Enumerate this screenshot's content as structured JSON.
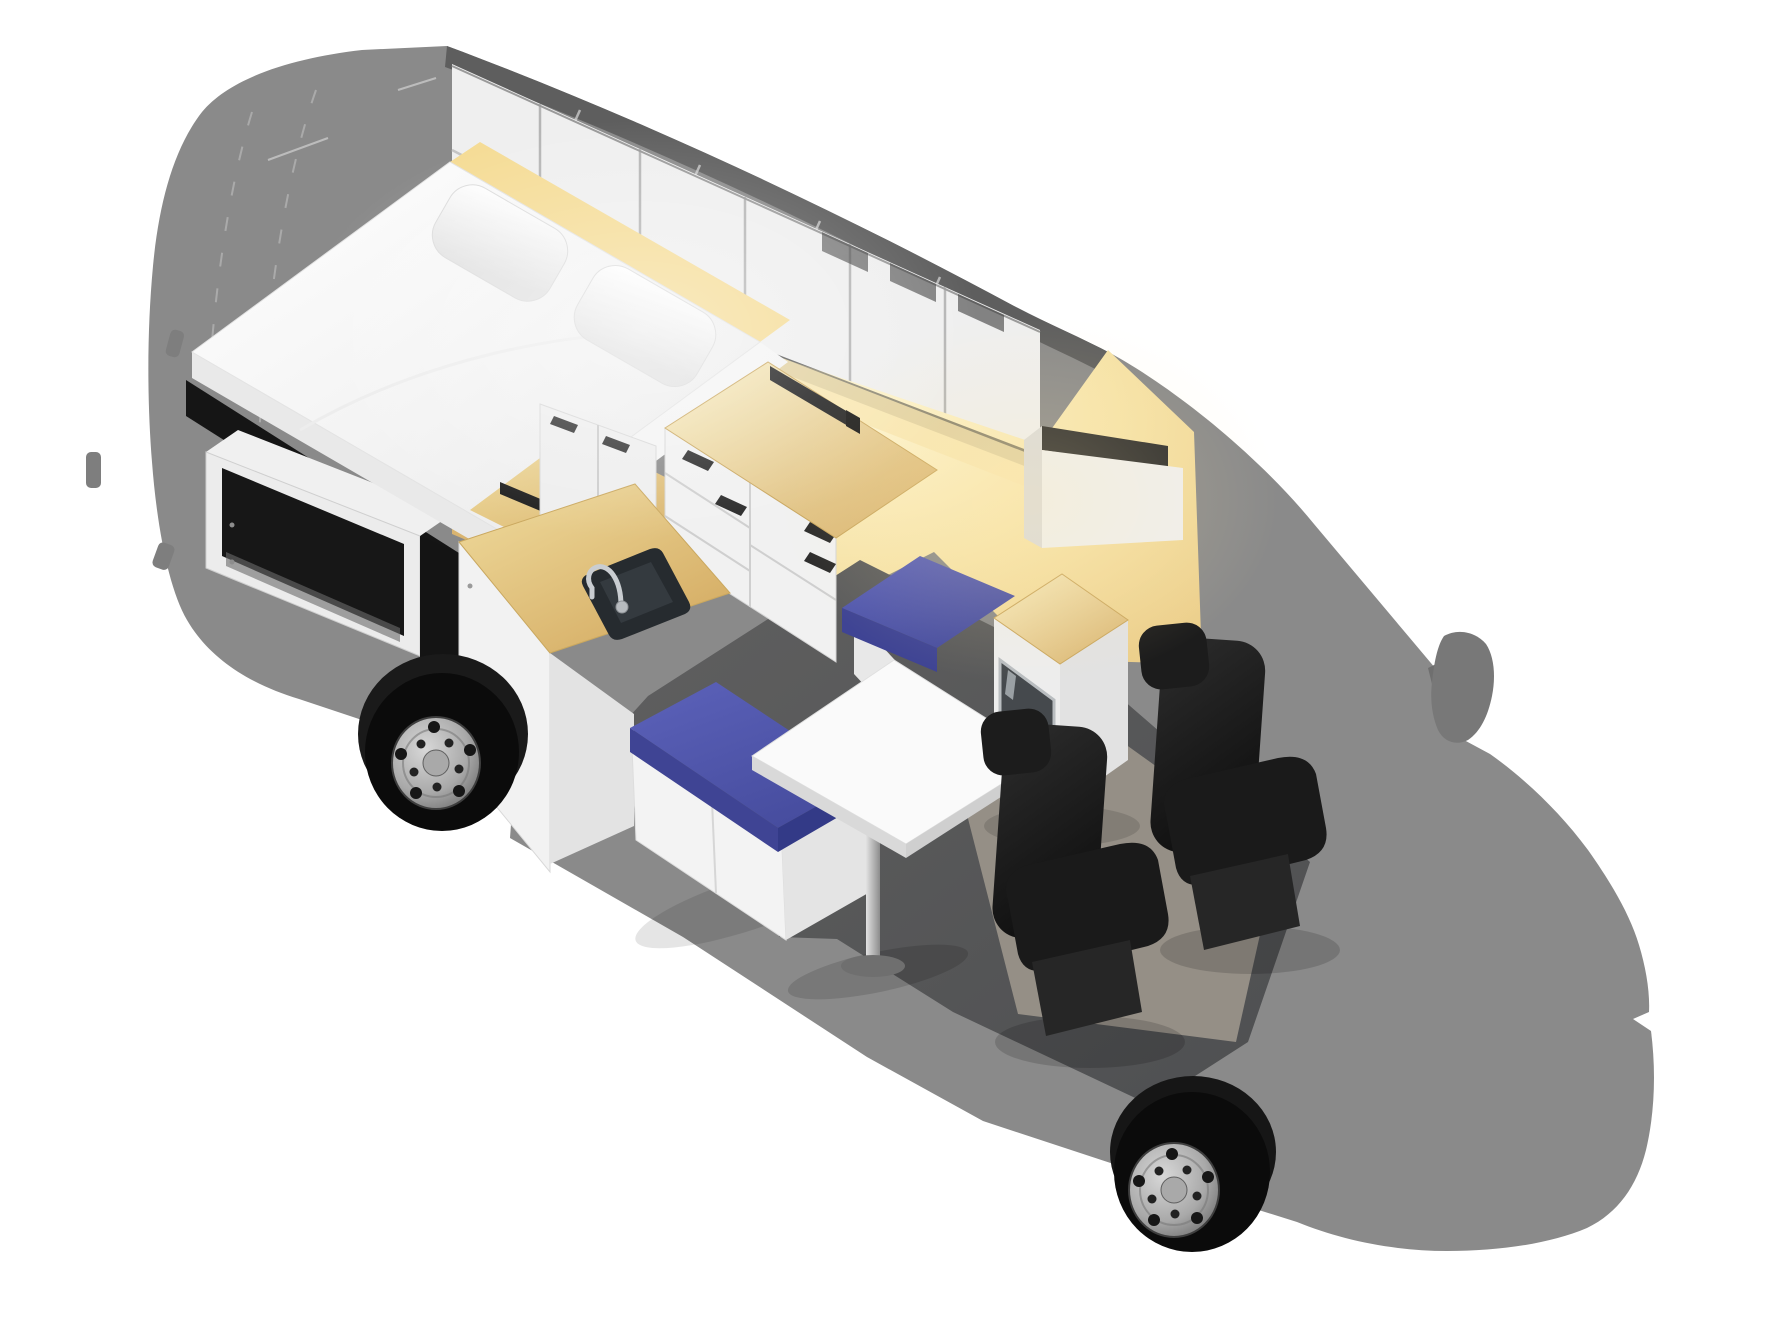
{
  "scene": {
    "title": "Campervan conversion — isometric cutaway render",
    "description": "3D cutaway of a gray van silhouette revealing a camper interior: rear double bed with pillows over a garage storage box, overhead cabinets, galley with sink and drawer unit, dinette with pedestal table and blue bench cushions, fridge cabinet and two swiveled black cab seats.",
    "background": "#ffffff"
  },
  "palette": {
    "background": "#ffffff",
    "van_body": "#8a8a8a",
    "roof_band": "#5e5e5e",
    "mirror": "#787878",
    "cabinet_front": "#efefef",
    "cabinet_divider": "#b5b5b5",
    "warm_bright": "#fdf4cf",
    "warm_mid": "#f6e3a8",
    "warm_deep": "#eccf8c",
    "wood_light": "#f4e6b2",
    "wood_dark": "#d9b470",
    "mattress": "#ffffff",
    "platform": "#e9e9e9",
    "garage_dark": "#171717",
    "unit_white": "#f2f2f2",
    "unit_shade": "#e3e3e3",
    "blue_top": "#5157ae",
    "blue_front": "#3f4494",
    "blue_side": "#333a87",
    "table_top": "#fafafa",
    "chrome_light": "#e2e2e2",
    "chrome_dark": "#8c8c8c",
    "sink_dark": "#262b2f",
    "fridge_door": "#45494d",
    "seat_dark": "#141414",
    "seat_mid": "#262626",
    "floor": "#575757",
    "carpet": "#9c968c",
    "tire": "#0b0b0b",
    "rim": "#c2c2c2",
    "light_bar": "#1e1e1e",
    "shadow_black": "#151515"
  },
  "components": [
    {
      "id": "van-body-silhouette",
      "label": "Gray van body shell"
    },
    {
      "id": "wing-mirror",
      "label": "Side wing mirror"
    },
    {
      "id": "roof-band",
      "label": "Roof edge band"
    },
    {
      "id": "overhead-cabinets",
      "label": "Overhead storage cabinets"
    },
    {
      "id": "bed",
      "label": "Fixed double bed"
    },
    {
      "id": "pillows",
      "label": "Two white pillows"
    },
    {
      "id": "garage-storage",
      "label": "Under-bed garage storage box"
    },
    {
      "id": "warm-wall",
      "label": "LED-lit interior wall"
    },
    {
      "id": "cab-overhead-shelf",
      "label": "Over-cab storage shelf"
    },
    {
      "id": "galley-back-counter",
      "label": "Wooden side counter"
    },
    {
      "id": "light-bars",
      "label": "Black LED light bars"
    },
    {
      "id": "kitchen-drawer-unit",
      "label": "Galley drawer unit with worktop"
    },
    {
      "id": "sink-unit",
      "label": "Sink unit with wooden counter"
    },
    {
      "id": "sink-basin",
      "label": "Inset sink basin"
    },
    {
      "id": "faucet",
      "label": "Chrome gooseneck faucet"
    },
    {
      "id": "front-bench",
      "label": "Bench seat with blue cushion"
    },
    {
      "id": "wall-bench",
      "label": "Wall bench with blue cushion"
    },
    {
      "id": "pedestal-table",
      "label": "White pedestal dinette table"
    },
    {
      "id": "fridge-unit",
      "label": "Fridge cabinet with wooden top"
    },
    {
      "id": "floor",
      "label": "Dark van floor"
    },
    {
      "id": "cab-carpet",
      "label": "Cab floor carpet"
    },
    {
      "id": "driver-seat",
      "label": "Driver swivel seat"
    },
    {
      "id": "passenger-seat",
      "label": "Passenger swivel seat"
    },
    {
      "id": "rear-wheel",
      "label": "Rear wheel"
    },
    {
      "id": "front-wheel",
      "label": "Front wheel"
    }
  ]
}
